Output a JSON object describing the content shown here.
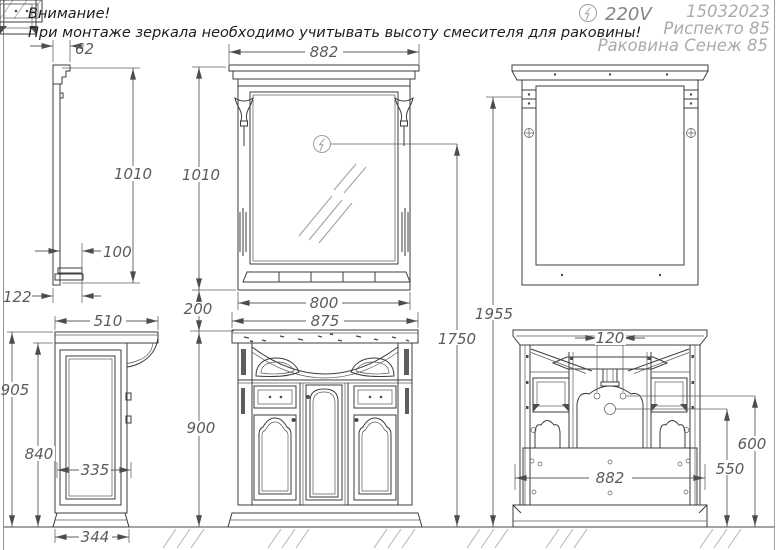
{
  "notice": {
    "line1": "Внимание!",
    "line2": "При монтаже зеркала необходимо учитывать высоту смесителя для раковины!"
  },
  "title_block": {
    "voltage": "220V",
    "code": "15032023",
    "model": "Риспекто 85",
    "sink": "Раковина Сенеж 85"
  },
  "dims": {
    "mirror_side": {
      "crown_depth": "62",
      "height": "1010",
      "shelf_depth": "100",
      "total_depth": "122"
    },
    "mirror_front": {
      "width": "882",
      "height": "1010",
      "body_width": "800"
    },
    "gap": "200",
    "mount": {
      "socket": "1750",
      "bracket": "1955"
    },
    "cab_side": {
      "top_depth": "510",
      "height": "905",
      "body_height": "840",
      "panel": "335",
      "base": "344"
    },
    "cab_front": {
      "width": "875",
      "height": "900"
    },
    "cab_rear": {
      "holes": "120",
      "width": "882",
      "right_h": "600",
      "center_h": "550"
    }
  }
}
